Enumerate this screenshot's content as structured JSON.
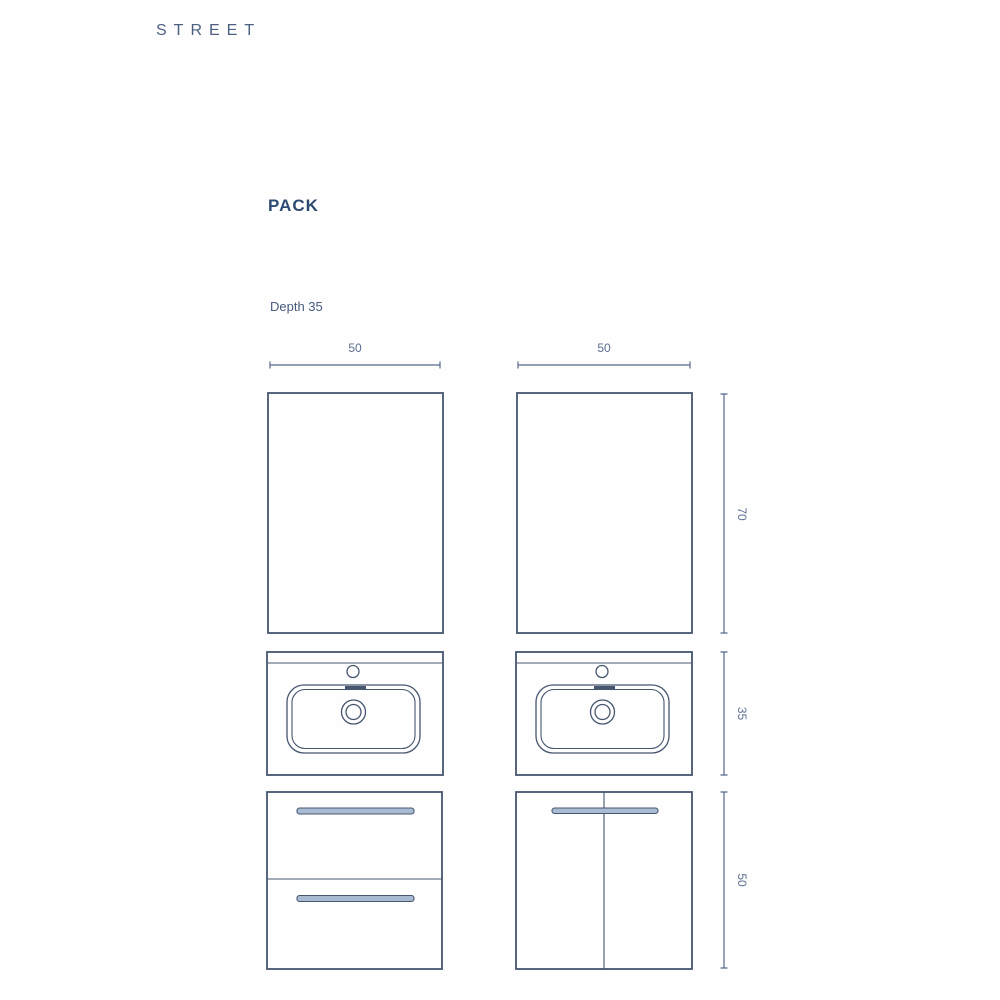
{
  "brand": "STREET",
  "heading": "PACK",
  "note": "Depth 35",
  "dimensions": {
    "left_unit_width": "50",
    "right_unit_width": "50",
    "mirror_height": "70",
    "washbasin_height": "35",
    "cabinet_height": "50"
  },
  "colors": {
    "line": "#46566f",
    "dim_line": "#56688a",
    "dim_text": "#5c6f92",
    "heading_text": "#2d4a73",
    "brand_text": "#4c6182",
    "note_text": "#455a7c",
    "handle_fill": "#a9bad3",
    "background": "#fefefe"
  }
}
